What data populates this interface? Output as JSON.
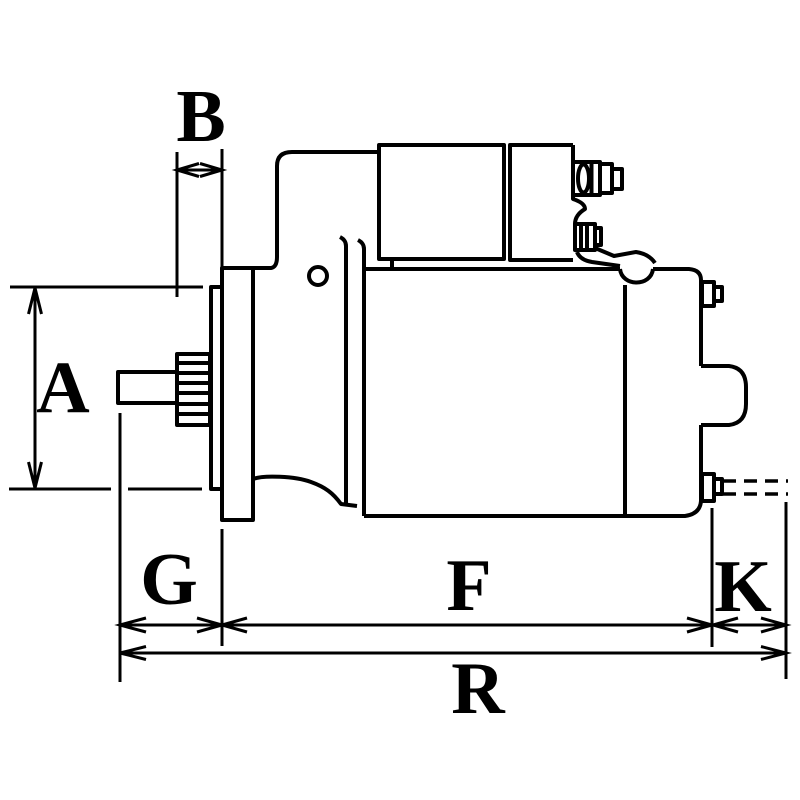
{
  "canvas": {
    "background_color": "#ffffff",
    "line_color": "#000000"
  },
  "dimension_labels": {
    "A": "A",
    "B": "B",
    "G": "G",
    "F": "F",
    "K": "K",
    "R": "R"
  }
}
